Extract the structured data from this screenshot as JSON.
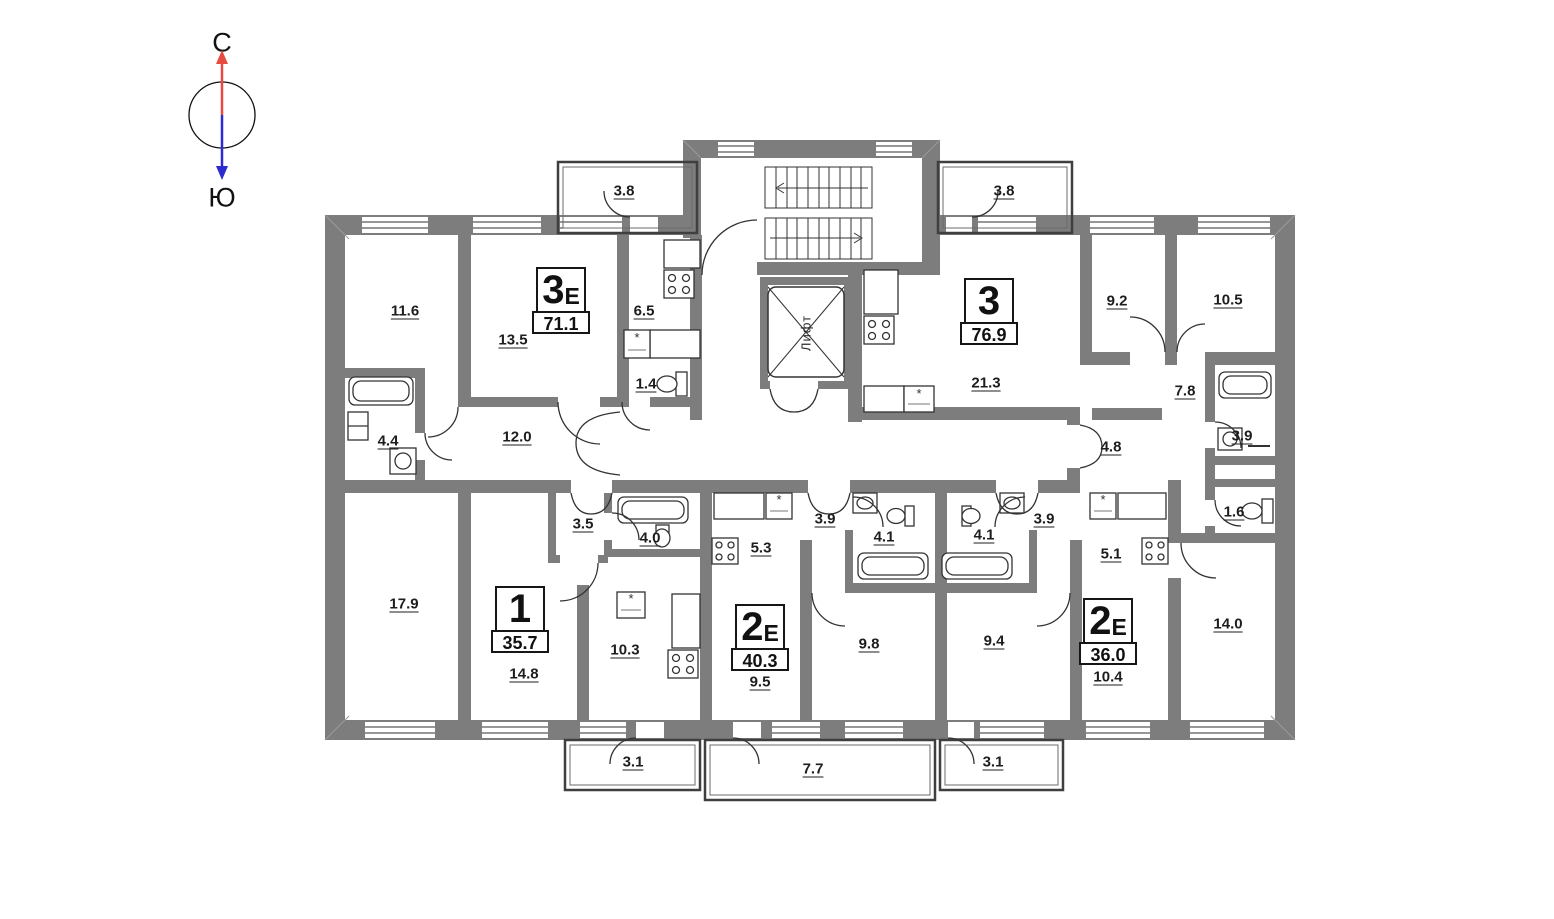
{
  "compass": {
    "north_label": "С",
    "south_label": "Ю",
    "north_color": "#e84a3f",
    "south_color": "#2b2bd0"
  },
  "core": {
    "elevator_label": "Лифт"
  },
  "colors": {
    "wall": "#7d7d7d",
    "line": "#333333",
    "thin_line": "#2f2f2f"
  },
  "icons": {
    "fridge_marker": "*",
    "stair_arrow_up_icon": "←",
    "stair_arrow_down_icon": "→"
  },
  "apartments": [
    {
      "digit": "3",
      "suffix": "Е",
      "area": "71.1"
    },
    {
      "digit": "3",
      "suffix": "",
      "area": "76.9"
    },
    {
      "digit": "1",
      "suffix": "",
      "area": "35.7"
    },
    {
      "digit": "2",
      "suffix": "Е",
      "area": "40.3"
    },
    {
      "digit": "2",
      "suffix": "Е",
      "area": "36.0"
    }
  ],
  "room_labels": [
    {
      "area": "11.6"
    },
    {
      "area": "13.5"
    },
    {
      "area": "6.5"
    },
    {
      "area": "1.4"
    },
    {
      "area": "3.8"
    },
    {
      "area": "3.8"
    },
    {
      "area": "12.0"
    },
    {
      "area": "4.4"
    },
    {
      "area": "17.9"
    },
    {
      "area": "3.5"
    },
    {
      "area": "4.0"
    },
    {
      "area": "14.8"
    },
    {
      "area": "10.3"
    },
    {
      "area": "5.3"
    },
    {
      "area": "9.5"
    },
    {
      "area": "3.9"
    },
    {
      "area": "4.1"
    },
    {
      "area": "9.8"
    },
    {
      "area": "9.4"
    },
    {
      "area": "4.1"
    },
    {
      "area": "3.9"
    },
    {
      "area": "5.1"
    },
    {
      "area": "10.4"
    },
    {
      "area": "14.0"
    },
    {
      "area": "1.6"
    },
    {
      "area": "3.9"
    },
    {
      "area": "7.8"
    },
    {
      "area": "4.8"
    },
    {
      "area": "21.3"
    },
    {
      "area": "9.2"
    },
    {
      "area": "10.5"
    },
    {
      "area": "3.1"
    },
    {
      "area": "7.7"
    },
    {
      "area": "3.1"
    }
  ]
}
